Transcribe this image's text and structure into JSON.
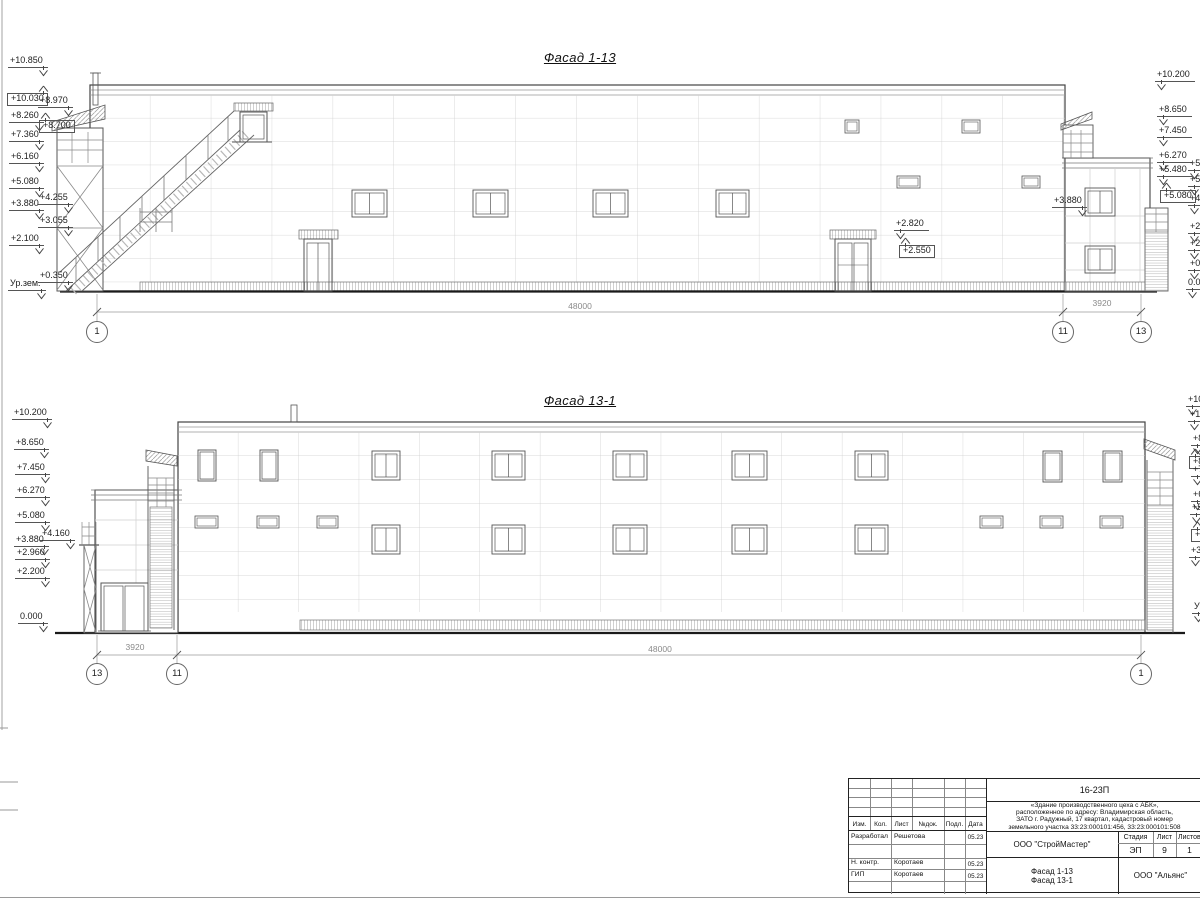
{
  "drawing": {
    "facade1": {
      "title": "Фасад 1-13",
      "dim_main": "48000",
      "dim_side": "3920",
      "axes": [
        "1",
        "11",
        "13"
      ],
      "marks": [
        {
          "t": "+10.850",
          "x": 8,
          "y": 56,
          "d": "dr"
        },
        {
          "t": "+10.030",
          "x": 7,
          "y": 93,
          "d": "ur",
          "b": 1
        },
        {
          "t": "+8.970",
          "x": 38,
          "y": 96,
          "d": "dr"
        },
        {
          "t": "+8.260",
          "x": 9,
          "y": 111,
          "d": "dr"
        },
        {
          "t": "+8.700",
          "x": 39,
          "y": 120,
          "d": "ul",
          "b": 1
        },
        {
          "t": "+7.360",
          "x": 9,
          "y": 130,
          "d": "dr"
        },
        {
          "t": "+6.160",
          "x": 9,
          "y": 152,
          "d": "dr"
        },
        {
          "t": "+5.080",
          "x": 9,
          "y": 177,
          "d": "dr"
        },
        {
          "t": "+4.255",
          "x": 38,
          "y": 193,
          "d": "dr"
        },
        {
          "t": "+3.880",
          "x": 9,
          "y": 199,
          "d": "dr"
        },
        {
          "t": "+3.055",
          "x": 38,
          "y": 216,
          "d": "dr"
        },
        {
          "t": "+2.100",
          "x": 9,
          "y": 234,
          "d": "dr"
        },
        {
          "t": "+0.350",
          "x": 38,
          "y": 271,
          "d": "dr"
        },
        {
          "t": "Ур.зем.",
          "x": 8,
          "y": 279,
          "d": "dr"
        },
        {
          "t": "+10.200",
          "x": 1155,
          "y": 70,
          "d": "dl"
        },
        {
          "t": "+8.650",
          "x": 1157,
          "y": 105,
          "d": "dl"
        },
        {
          "t": "+7.450",
          "x": 1157,
          "y": 126,
          "d": "dl"
        },
        {
          "t": "+6.270",
          "x": 1157,
          "y": 151,
          "d": "dl"
        },
        {
          "t": "+5.480",
          "x": 1157,
          "y": 165,
          "d": "dl"
        },
        {
          "t": "+5.080",
          "x": 1160,
          "y": 190,
          "d": "ul",
          "b": 1
        },
        {
          "t": "+5.",
          "x": 1188,
          "y": 159,
          "d": "dl"
        },
        {
          "t": "+5.",
          "x": 1188,
          "y": 175,
          "d": "dl"
        },
        {
          "t": "+4.",
          "x": 1188,
          "y": 194,
          "d": "dl"
        },
        {
          "t": "+2.",
          "x": 1188,
          "y": 222,
          "d": "dl"
        },
        {
          "t": "+2.",
          "x": 1188,
          "y": 239,
          "d": "dl"
        },
        {
          "t": "+0.",
          "x": 1188,
          "y": 259,
          "d": "dl"
        },
        {
          "t": "0.0",
          "x": 1186,
          "y": 278,
          "d": "dl"
        },
        {
          "t": "+2.820",
          "x": 894,
          "y": 219,
          "d": "dl"
        },
        {
          "t": "+2.550",
          "x": 899,
          "y": 245,
          "d": "ul",
          "b": 1
        },
        {
          "t": "+3.880",
          "x": 1052,
          "y": 196,
          "d": "dr"
        }
      ]
    },
    "facade2": {
      "title": "Фасад 13-1",
      "dim_main": "48000",
      "dim_side": "3920",
      "axes": [
        "13",
        "11",
        "1"
      ],
      "marks": [
        {
          "t": "+10.200",
          "x": 12,
          "y": 408,
          "d": "dr"
        },
        {
          "t": "+8.650",
          "x": 14,
          "y": 438,
          "d": "dr"
        },
        {
          "t": "+7.450",
          "x": 15,
          "y": 463,
          "d": "dr"
        },
        {
          "t": "+6.270",
          "x": 15,
          "y": 486,
          "d": "dr"
        },
        {
          "t": "+5.080",
          "x": 15,
          "y": 511,
          "d": "dr"
        },
        {
          "t": "+4.160",
          "x": 40,
          "y": 529,
          "d": "dr"
        },
        {
          "t": "+3.880",
          "x": 14,
          "y": 535,
          "d": "dr"
        },
        {
          "t": "+2.960",
          "x": 15,
          "y": 548,
          "d": "dr"
        },
        {
          "t": "+2.200",
          "x": 15,
          "y": 567,
          "d": "dr"
        },
        {
          "t": "0.000",
          "x": 18,
          "y": 612,
          "d": "dr"
        },
        {
          "t": "+10",
          "x": 1186,
          "y": 395,
          "d": "dl"
        },
        {
          "t": "+10",
          "x": 1188,
          "y": 410,
          "d": "dl"
        },
        {
          "t": "+8",
          "x": 1191,
          "y": 434,
          "d": "dl"
        },
        {
          "t": "+8",
          "x": 1189,
          "y": 456,
          "d": "ul",
          "b": 1
        },
        {
          "t": "+7",
          "x": 1191,
          "y": 465,
          "d": "dl"
        },
        {
          "t": "+6",
          "x": 1191,
          "y": 490,
          "d": "dl"
        },
        {
          "t": "+5",
          "x": 1190,
          "y": 503,
          "d": "dl"
        },
        {
          "t": "+5",
          "x": 1191,
          "y": 529,
          "d": "ul",
          "b": 1
        },
        {
          "t": "+3",
          "x": 1189,
          "y": 546,
          "d": "dl"
        },
        {
          "t": "Ур",
          "x": 1192,
          "y": 602,
          "d": "dl"
        }
      ]
    }
  },
  "titleblock": {
    "code": "16-23П",
    "description_lines": [
      "«Здание производственного цеха с АБК»,",
      "расположенное по адресу: Владимирская область,",
      "ЗАТО г. Радужный, 17 квартал, кадастровый номер",
      "земельного участка 33:23:000101:456, 33:23:000101:508"
    ],
    "design_org": "ООО \"СтройМастер\"",
    "contractor_org": "ООО \"Альянс\"",
    "stage_label": "Стадия",
    "sheet_label": "Лист",
    "sheets_label": "Листов",
    "stage_value": "ЭП",
    "sheet_value": "9",
    "sheets_value": "1",
    "view_lines": [
      "Фасад 1-13",
      "Фасад 13-1"
    ],
    "header_cols": [
      "Изм.",
      "Кол.",
      "Лист",
      "№док.",
      "Подл.",
      "Дата"
    ],
    "rows": [
      {
        "role": "Разработал",
        "name": "Решетова",
        "date": "05.23"
      },
      {
        "role": "",
        "name": "",
        "date": ""
      },
      {
        "role": "Н. контр.",
        "name": "Коротаев",
        "date": "05.23"
      },
      {
        "role": "ГИП",
        "name": "Коротаев",
        "date": "05.23"
      }
    ]
  }
}
